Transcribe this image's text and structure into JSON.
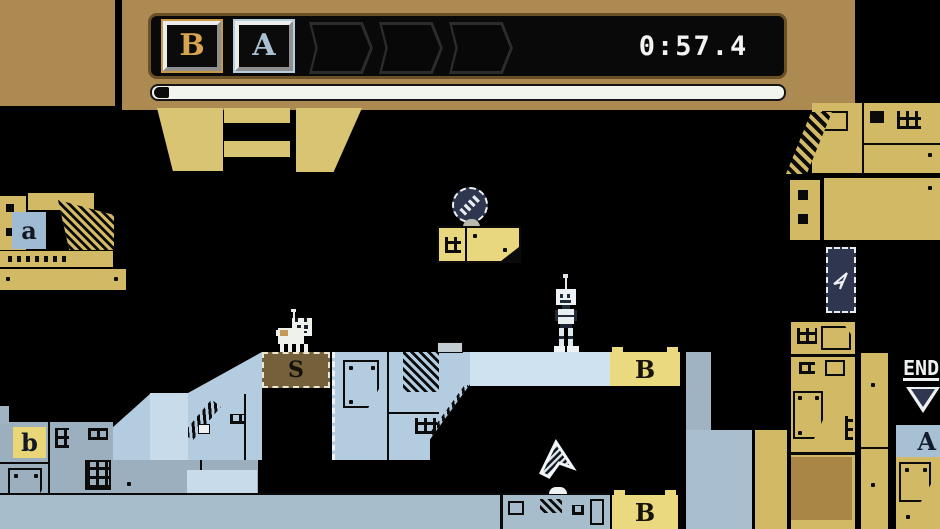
{
  "hud": {
    "timer": "0:57.4",
    "slots": [
      {
        "letter": "B",
        "state": "collected"
      },
      {
        "letter": "A",
        "state": "collected"
      },
      {
        "letter": "",
        "state": "empty"
      },
      {
        "letter": "",
        "state": "empty"
      },
      {
        "letter": "",
        "state": "empty"
      }
    ],
    "progress_percent": 2
  },
  "level": {
    "tiles": {
      "a_small": "a",
      "b_small": "b",
      "b_platform": "B",
      "b_bottom": "B",
      "a_right": "A"
    },
    "end_sign": "END",
    "blocked_glyph": "S"
  },
  "colors": {
    "banner": "#ad8a52",
    "khaki": "#d9c473",
    "tan": "#d2b966",
    "platform_blue": "#b4cce0",
    "slate": "#9cafbe",
    "portal_navy": "#2e3650",
    "hud_gold": "#d9a450",
    "hud_blue": "#a9bfd2"
  }
}
